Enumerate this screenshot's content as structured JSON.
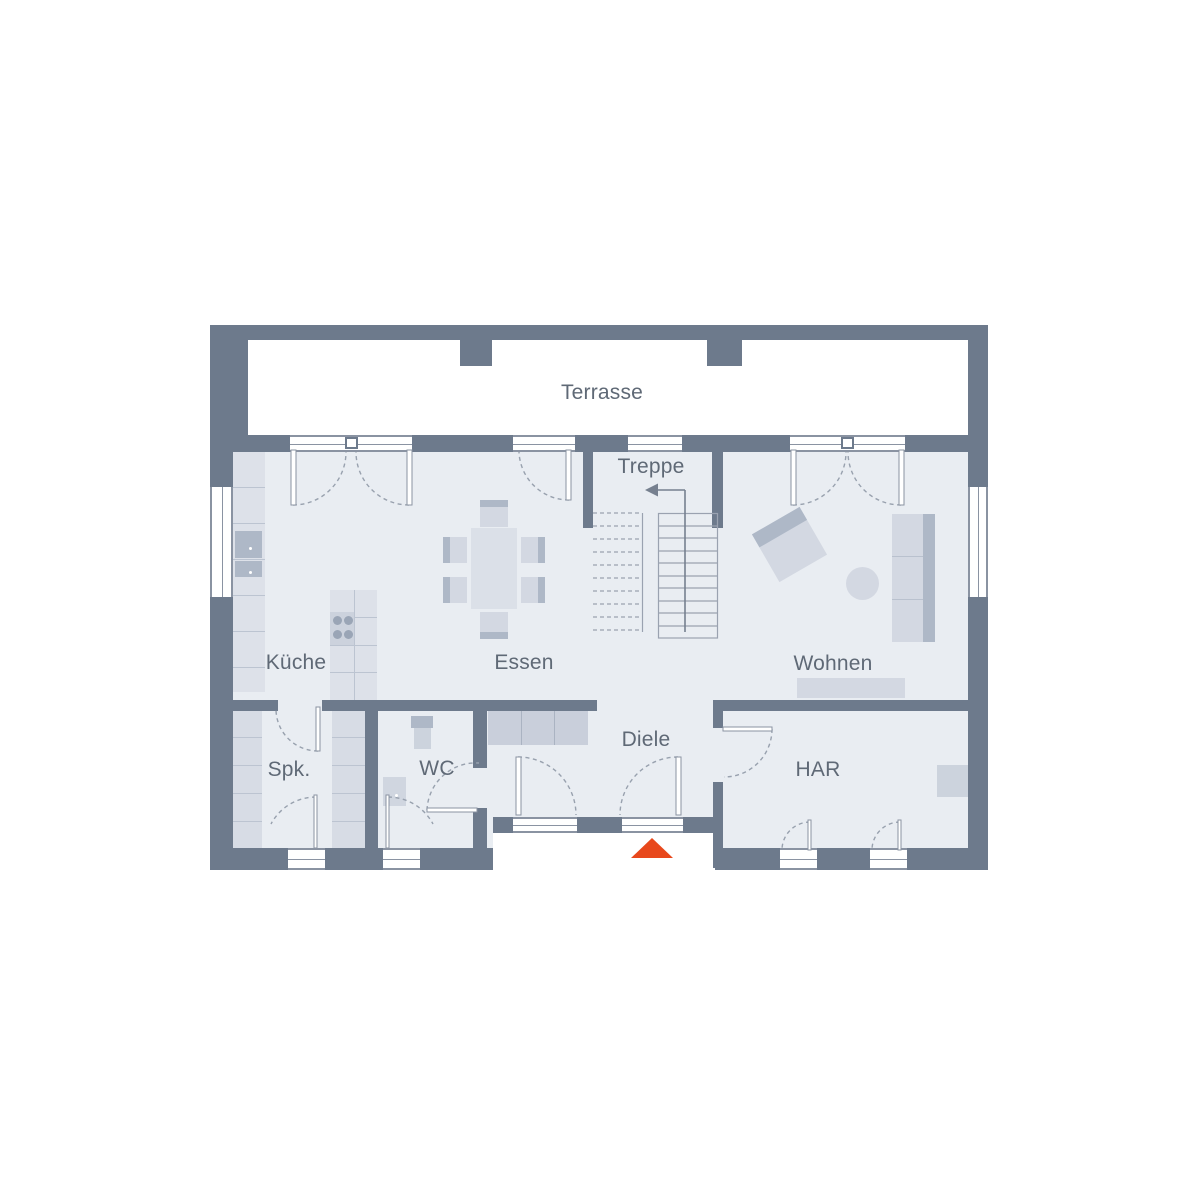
{
  "plan": {
    "type": "architectural-floor-plan",
    "rooms": {
      "terrasse": "Terrasse",
      "treppe": "Treppe",
      "kueche": "Küche",
      "essen": "Essen",
      "wohnen": "Wohnen",
      "spk": "Spk.",
      "wc": "WC",
      "diele": "Diele",
      "har": "HAR"
    },
    "colors": {
      "wall": "#6d7a8c",
      "floor": "#e9edf2",
      "line": "#8a93a2",
      "furniture_light": "#d3d8e2",
      "furniture_dark": "#aeb8c7",
      "label_text": "#5f6976",
      "entrance_marker": "#e8481c"
    },
    "markers": {
      "entrance": "entrance-triangle",
      "stair_direction": "arrow-up-left"
    }
  }
}
